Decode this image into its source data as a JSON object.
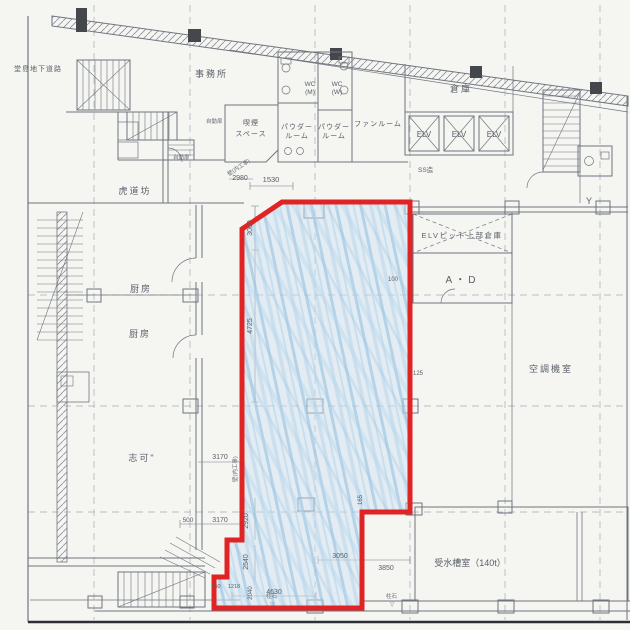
{
  "rooms": {
    "dojima": "堂島地下道路",
    "office": "事務所",
    "smoking1": "喫煙",
    "smoking2": "スペース",
    "powder1": "パウダー",
    "powder2": "ルーム",
    "wc_m1": "WC",
    "wc_m2": "(M)",
    "wc_w1": "WC",
    "wc_w2": "(W)",
    "fan": "ファンルーム",
    "warehouse": "倉庫",
    "elv": "ELV",
    "ss": "SS造",
    "torado": "虎道坊",
    "kitchen": "厨房",
    "elv_pit": "ELVピット上部倉庫",
    "ad": "A・D",
    "hvac": "空調機室",
    "shika": "志可\"",
    "water_tank": "受水槽室（140t）",
    "y_marker": "Y"
  },
  "annotations": {
    "auto_door": "自動扉",
    "wall_note": "壁(内工事)",
    "pillar": "柱石",
    "triangle": "▽"
  },
  "dimensions": {
    "d2980": "2980",
    "d1530": "1530",
    "d3000": "3000",
    "d4725": "4725",
    "d3170a": "3170",
    "d500": "500",
    "d3170b": "3170",
    "d2920": "2920",
    "d2540": "2540",
    "d2040": "2040",
    "d4630": "4630",
    "d3050": "3050",
    "d3850": "3850",
    "d100": "100",
    "d125": "125",
    "d165": "165",
    "d650": "650",
    "d1218": "1218"
  },
  "colors": {
    "lease_outline": "#e02424",
    "lease_fill": "#cfe2f2",
    "linework": "#7a808a"
  }
}
